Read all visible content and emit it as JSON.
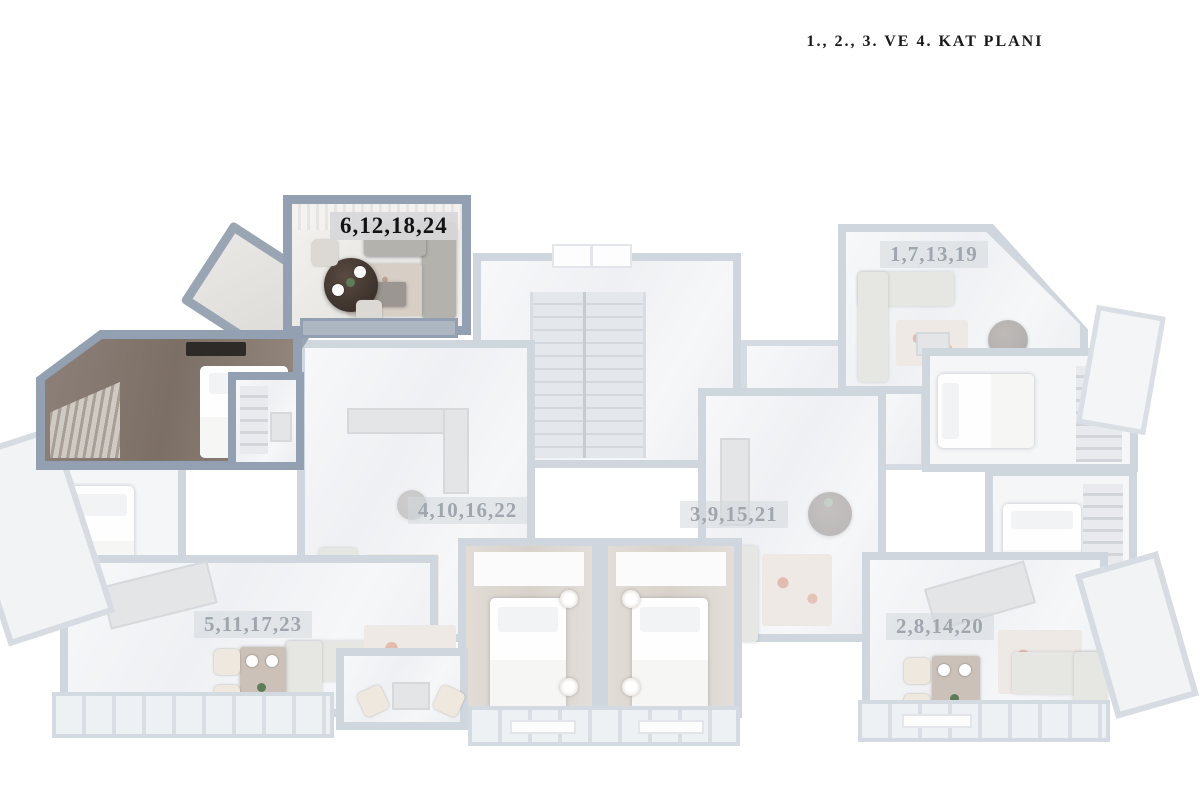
{
  "title": "1., 2., 3. VE 4. KAT PLANI",
  "plan": {
    "type": "architectural-floor-plan-3d-render",
    "highlighted_unit": "6,12,18,24",
    "highlight_wall_color": "#93a0b2",
    "faded_wall_color": "#cfd6de",
    "background_color": "#ffffff",
    "units": [
      {
        "id": "unit-6",
        "label": "6,12,18,24",
        "highlighted": true
      },
      {
        "id": "unit-1",
        "label": "1,7,13,19",
        "highlighted": false
      },
      {
        "id": "unit-4",
        "label": "4,10,16,22",
        "highlighted": false
      },
      {
        "id": "unit-3",
        "label": "3,9,15,21",
        "highlighted": false
      },
      {
        "id": "unit-5",
        "label": "5,11,17,23",
        "highlighted": false
      },
      {
        "id": "unit-2",
        "label": "2,8,14,20",
        "highlighted": false
      }
    ]
  }
}
